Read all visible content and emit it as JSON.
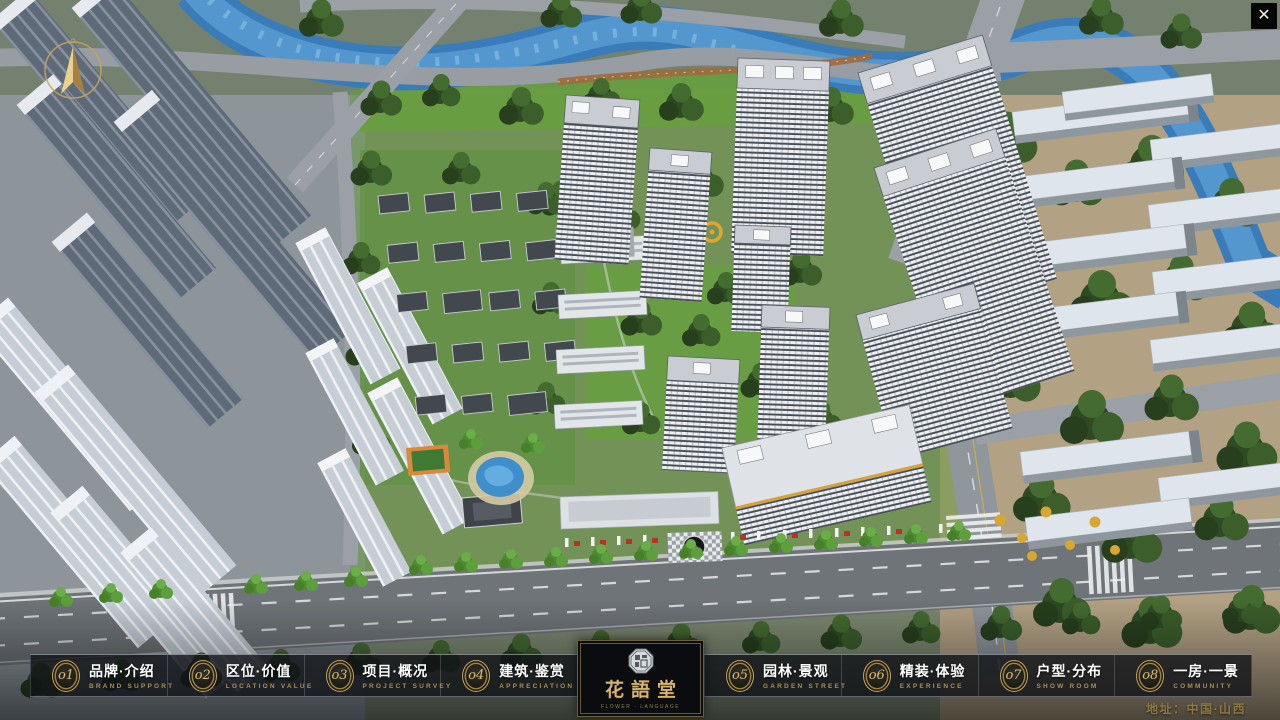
{
  "window": {
    "close_label": "✕"
  },
  "icons": {
    "compass": "compass-north-arrow",
    "close": "close-x",
    "seal": "octagon-seal-emblem"
  },
  "nav": {
    "items": [
      {
        "num": "o1",
        "label": "品牌·介绍",
        "sub": "BRAND SUPPORT"
      },
      {
        "num": "o2",
        "label": "区位·价值",
        "sub": "LOCATION VALUE"
      },
      {
        "num": "o3",
        "label": "项目·概况",
        "sub": "PROJECT SURVEY"
      },
      {
        "num": "o4",
        "label": "建筑·鉴赏",
        "sub": "APPRECIATION"
      },
      {
        "num": "o5",
        "label": "园林·景观",
        "sub": "GARDEN STREET"
      },
      {
        "num": "o6",
        "label": "精装·体验",
        "sub": "EXPERIENCE"
      },
      {
        "num": "o7",
        "label": "户型·分布",
        "sub": "SHOW ROOM"
      },
      {
        "num": "o8",
        "label": "一房·一景",
        "sub": "COMMUNITY"
      }
    ]
  },
  "logo": {
    "title": "花語堂",
    "caption": "FLOWER · LANGUAGE"
  },
  "footer": {
    "address": "地址：中国·山西"
  },
  "scene": {
    "description": "aerial 3d render of residential development",
    "colors": {
      "river": "#3a7cba",
      "pool": "#3e8fcb",
      "road": "#979da3",
      "lawn": "#66a040",
      "ground_east": "#b3a184",
      "ground_west": "#8d949a",
      "tower_roof": "#c9cdd3",
      "tree_dark": "#2e4a23",
      "gold_accent": "#c9a45c",
      "red_accent": "#bf2f26"
    }
  }
}
